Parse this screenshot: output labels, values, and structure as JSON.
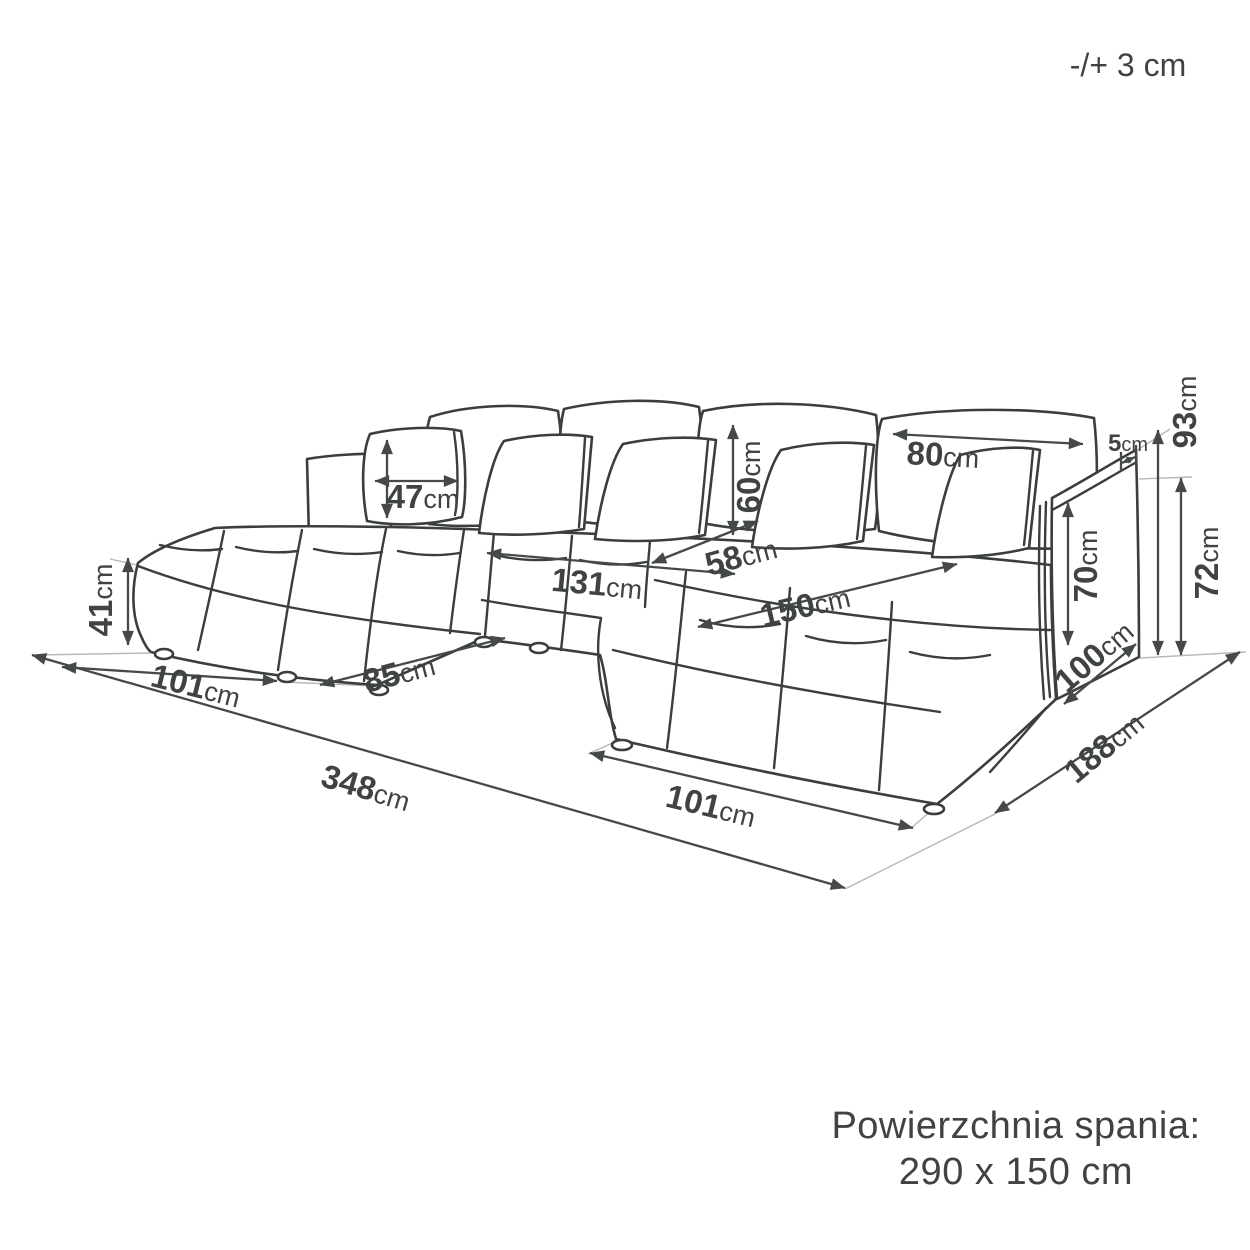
{
  "annotation_note": "-/+ 3 cm",
  "sleeping_area": {
    "label": "Powierzchnia spania:",
    "size": "290 x 150 cm"
  },
  "dimensions": {
    "seat_height": {
      "value": "41",
      "unit": "cm"
    },
    "left_chaise_width": {
      "value": "101",
      "unit": "cm"
    },
    "front_depth_gap": {
      "value": "85",
      "unit": "cm"
    },
    "total_width": {
      "value": "348",
      "unit": "cm"
    },
    "right_chaise_width": {
      "value": "101",
      "unit": "cm"
    },
    "total_depth": {
      "value": "188",
      "unit": "cm"
    },
    "right_chaise_length": {
      "value": "150",
      "unit": "cm"
    },
    "center_seat_width": {
      "value": "131",
      "unit": "cm"
    },
    "seat_depth": {
      "value": "58",
      "unit": "cm"
    },
    "back_cushion_height": {
      "value": "60",
      "unit": "cm"
    },
    "back_cushion_width": {
      "value": "80",
      "unit": "cm"
    },
    "small_pillow_size": {
      "value": "47",
      "unit": "cm"
    },
    "armrest_inner_height": {
      "value": "70",
      "unit": "cm"
    },
    "armrest_length": {
      "value": "100",
      "unit": "cm"
    },
    "total_height": {
      "value": "93",
      "unit": "cm"
    },
    "backrest_height": {
      "value": "72",
      "unit": "cm"
    },
    "armrest_thickness": {
      "value": "5",
      "unit": "cm"
    }
  },
  "colors": {
    "line": "#3a3e3c",
    "dimension_line": "#454a47",
    "text": "#3f4440",
    "extension_line": "#b5b9b6",
    "background": "#ffffff"
  }
}
